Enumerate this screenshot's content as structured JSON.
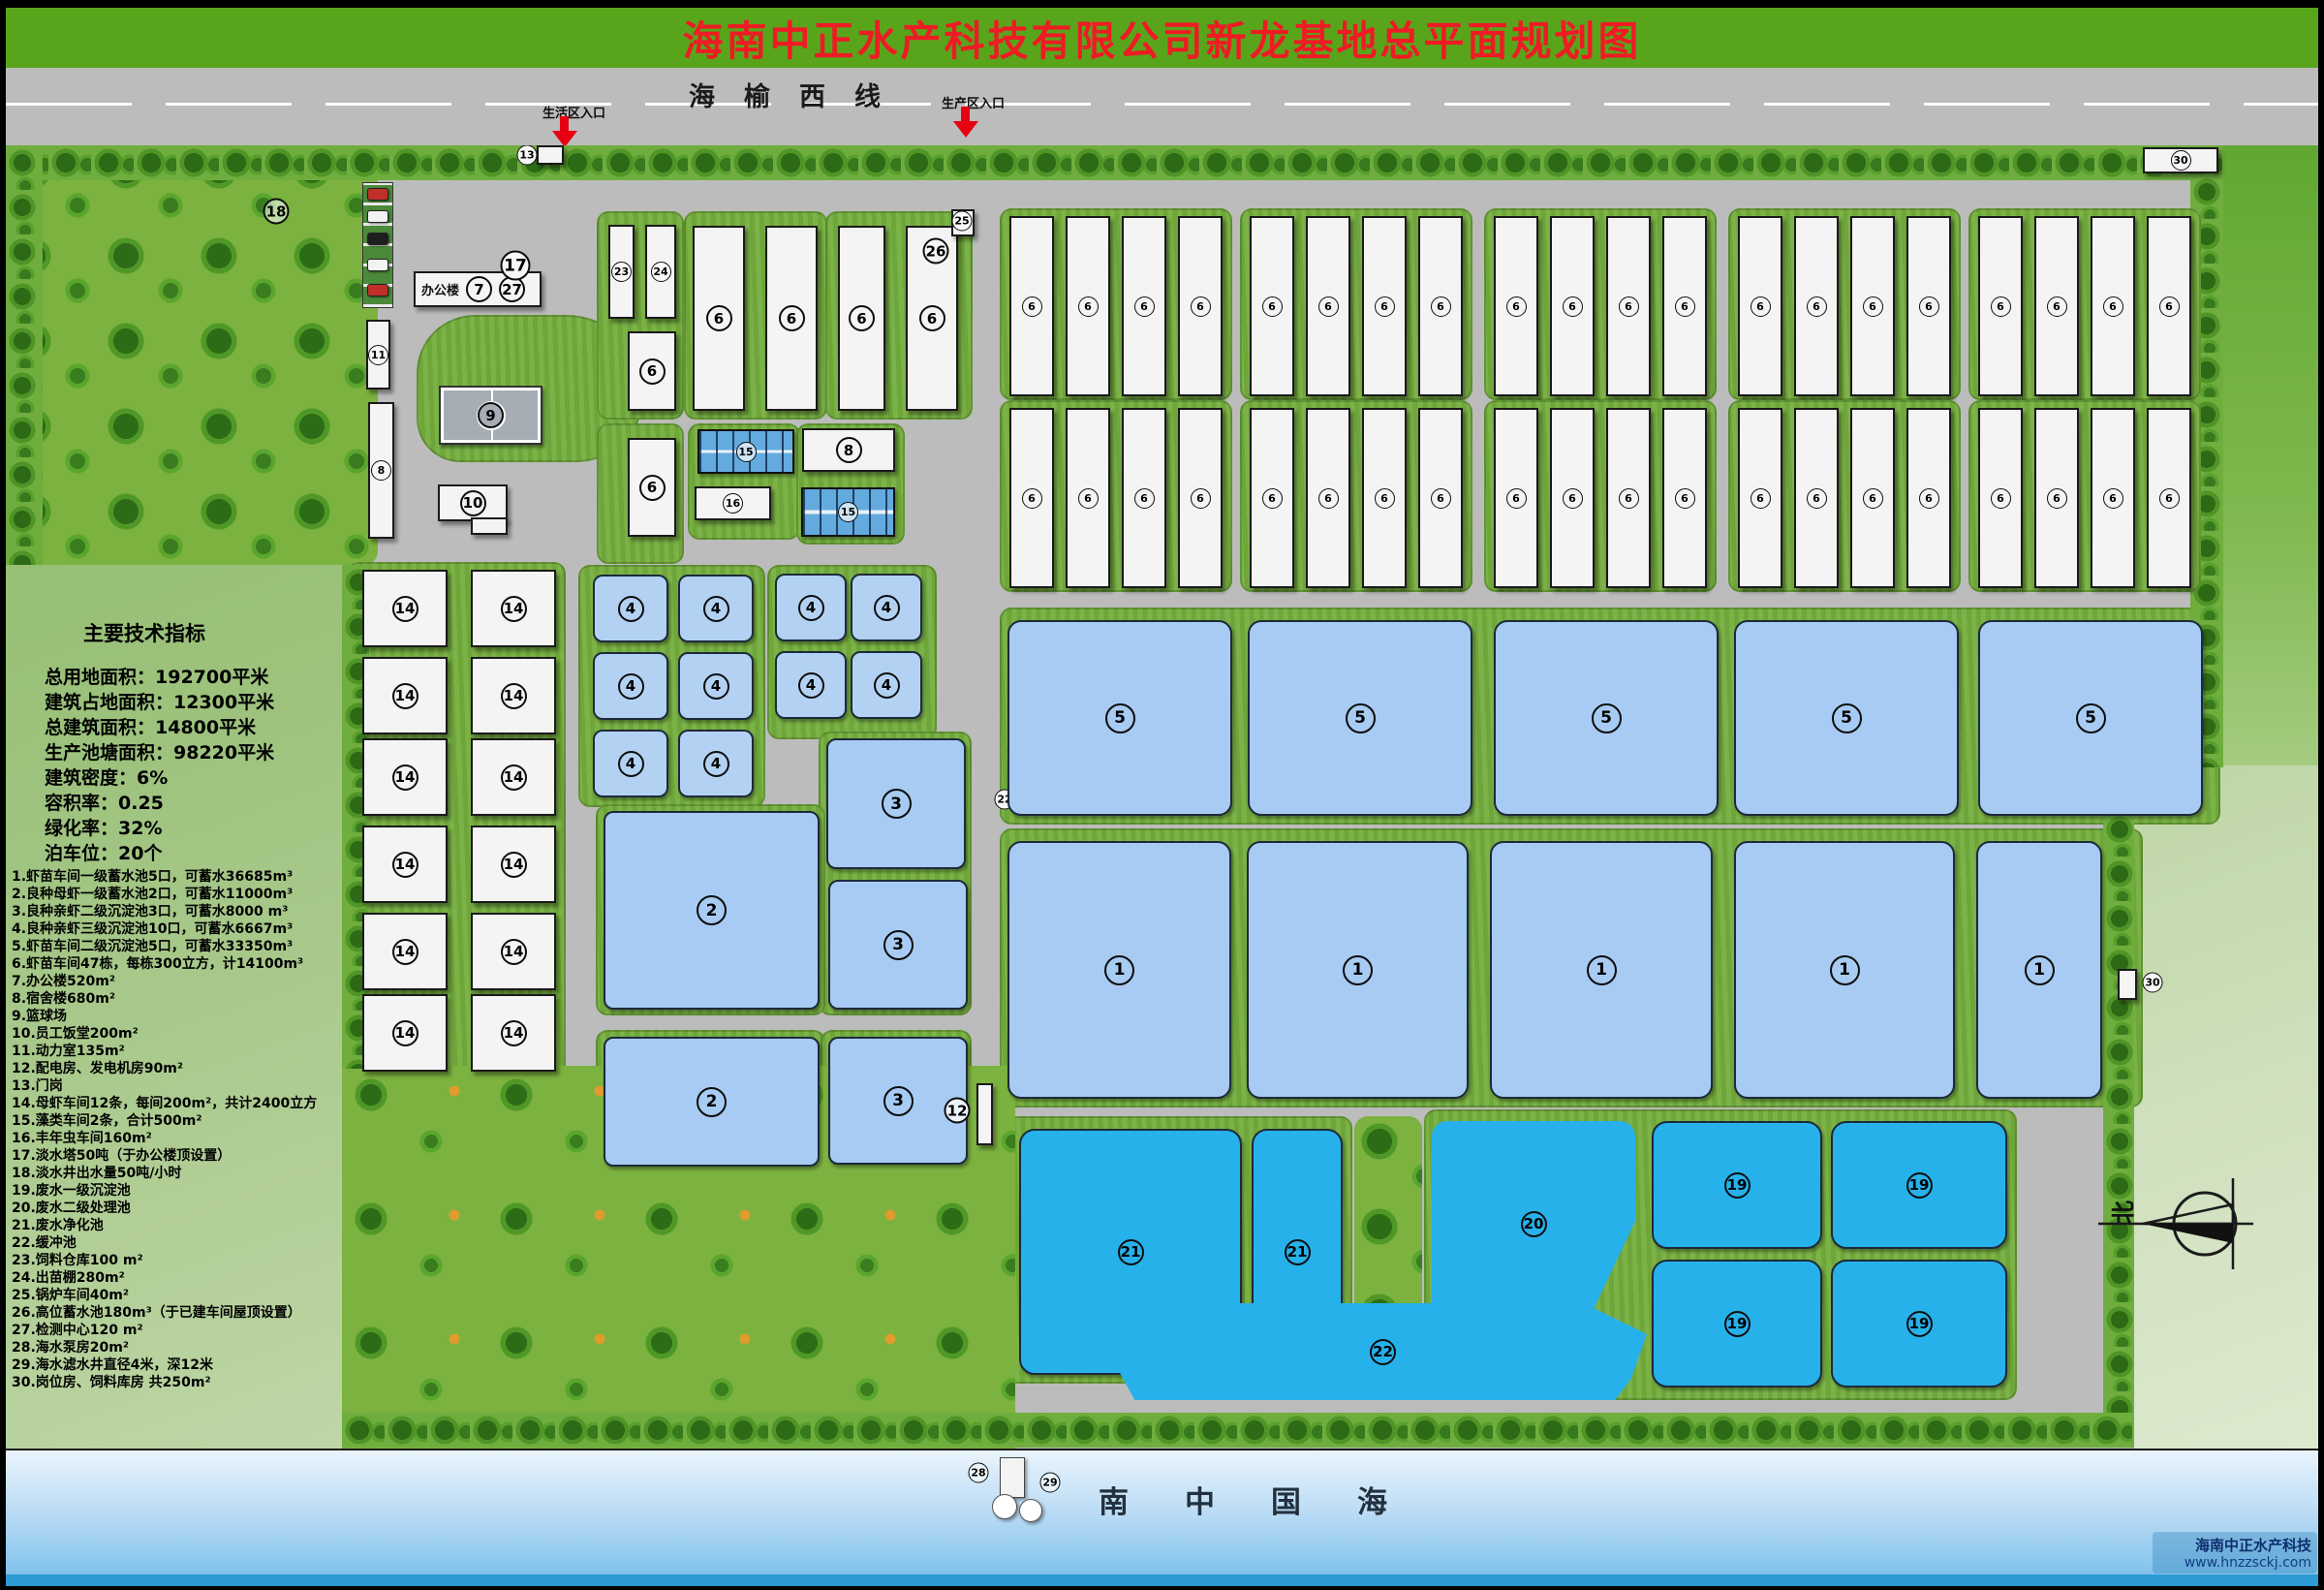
{
  "title": "海南中正水产科技有限公司新龙基地总平面规划图",
  "road": {
    "name": "海榆西线",
    "entrance_life": "生活区入口",
    "entrance_prod": "生产区入口"
  },
  "indicators": {
    "title": "主要技术指标",
    "lines": [
      "总用地面积：192700平米",
      "建筑占地面积：12300平米",
      "总建筑面积：14800平米",
      "生产池塘面积：98220平米",
      "建筑密度：6%",
      "容积率：0.25",
      "绿化率：32%",
      "泊车位：20个"
    ]
  },
  "legend": {
    "items": [
      "1.虾苗车间一级蓄水池5口，可蓄水36685m³",
      "2.良种母虾一级蓄水池2口，可蓄水11000m³",
      "3.良种亲虾二级沉淀池3口，可蓄水8000 m³",
      "4.良种亲虾三级沉淀池10口，可蓄水6667m³",
      "5.虾苗车间二级沉淀池5口，可蓄水33350m³",
      "6.虾苗车间47栋，每栋300立方，计14100m³",
      "7.办公楼520m²",
      "8.宿舍楼680m²",
      "9.篮球场",
      "10.员工饭堂200m²",
      "11.动力室135m²",
      "12.配电房、发电机房90m²",
      "13.门岗",
      "14.母虾车间12条，每间200m²，共计2400立方",
      "15.藻类车间2条，合计500m²",
      "16.丰年虫车间160m²",
      "17.淡水塔50吨（于办公楼顶设置）",
      "18.淡水井出水量50吨/小时",
      "19.废水一级沉淀池",
      "20.废水二级处理池",
      "21.废水净化池",
      "22.缓冲池",
      "23.饲料仓库100 m²",
      "24.出苗棚280m²",
      "25.锅炉车间40m²",
      "26.高位蓄水池180m³（于已建车间屋顶设置）",
      "27.检测中心120 m²",
      "28.海水泵房20m²",
      "29.海水滤水井直径4米，深12米",
      "30.岗位房、饲料库房 共250m²"
    ]
  },
  "labels": {
    "office": "办公楼",
    "sea": "南中国海",
    "north": "北"
  },
  "watermark": {
    "line1": "海南中正水产科技",
    "line2": "www.hnzzsckj.com"
  },
  "markers": {
    "forest": "18",
    "gate": "13",
    "office_7": "7",
    "office_27": "27",
    "water_tower_17": "17",
    "basketball": "9",
    "canteen": "10",
    "power_room": "11",
    "dormitory": "8",
    "mid_dorm": "8",
    "feed_warehouse": "23",
    "seedling_shed": "24",
    "boiler": "25",
    "high_tank": "26",
    "workshop": "6",
    "algae": "15",
    "brine_worm": "16",
    "pond1": "1",
    "pond2": "2",
    "pond3": "3",
    "pond4": "4",
    "pond5": "5",
    "mother": "14",
    "power_dist": "12",
    "waste1_19": "19",
    "waste2_20": "20",
    "purify_21": "21",
    "buffer_22": "22",
    "sea_pump_28": "28",
    "sea_well_29": "29",
    "post_30": "30"
  },
  "site": {
    "workshop_label": "6",
    "workshop_rows": 2,
    "workshop_blocks_per_row": 5,
    "workshops_per_block": 4,
    "mother_label": "14",
    "mother_rows": 6,
    "mother_cols": 2,
    "pond4_label": "4",
    "pond4_count": 10,
    "pond5_label": "5",
    "pond5_count": 5,
    "pond1_label": "1",
    "pond1_count": 5,
    "pond19_label": "19",
    "pond19_count": 4
  },
  "colors": {
    "header_green": "#58a51c",
    "title_red": "#ee1b24",
    "road_gray": "#bcbcbc",
    "lawn_green": "#7cb23f",
    "block_green": "#74ae3d",
    "pool_light_blue": "#a7cbf2",
    "pool_dark_cyan": "#27b1eb",
    "pool_grid_blue": "#63aade",
    "sea_blue": "#7fc2ec",
    "arrow_red": "#e60012"
  }
}
